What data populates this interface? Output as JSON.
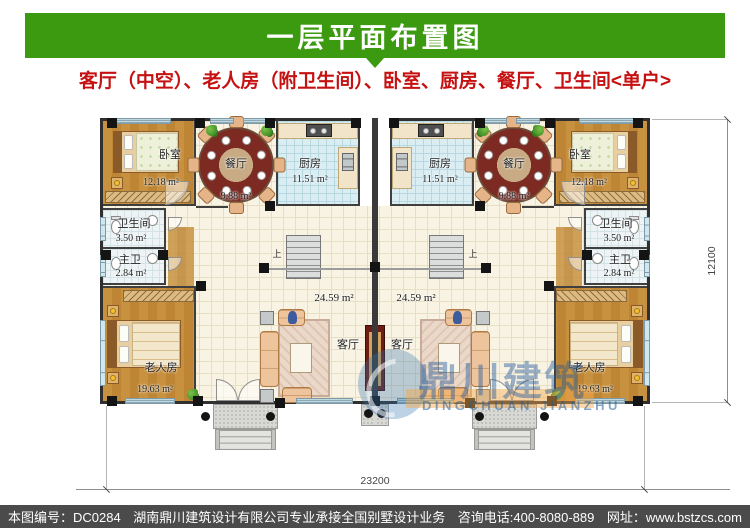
{
  "header": {
    "title": "一层平面布置图"
  },
  "subtitle": {
    "text": "客厅（中空）、老人房（附卫生间）、卧室、厨房、餐厅、卫生间<单户>"
  },
  "plan": {
    "rooms": {
      "bedroom": {
        "label": "卧室",
        "area": "12.18 m²"
      },
      "dining": {
        "label": "餐厅",
        "area": "9.88 m²"
      },
      "kitchen": {
        "label": "厨房",
        "area": "11.51 m²"
      },
      "bath": {
        "label": "卫生间",
        "area": "3.50 m²"
      },
      "master_bath": {
        "label": "主卫",
        "area": "2.84 m²"
      },
      "elder_room": {
        "label": "老人房",
        "area": "19.63 m²"
      },
      "living": {
        "label": "客厅",
        "area": "24.59 m²"
      }
    },
    "stairs_label": "上",
    "dimensions": {
      "width": "23200",
      "height": "12100"
    },
    "watermark": {
      "cn": "鼎川建筑",
      "en": "DINGCHUAN JIANZHU"
    },
    "colors": {
      "header_green": "#3c9a10",
      "subtitle_red": "#c51111",
      "footer_gray": "#4b4b4b"
    }
  },
  "footer": {
    "items": [
      "本图编号：DC0284",
      "湖南鼎川建筑设计有限公司专业承接全国别墅设计业务",
      "咨询电话:400-8080-889",
      "网址：www.bstzcs.com"
    ]
  }
}
